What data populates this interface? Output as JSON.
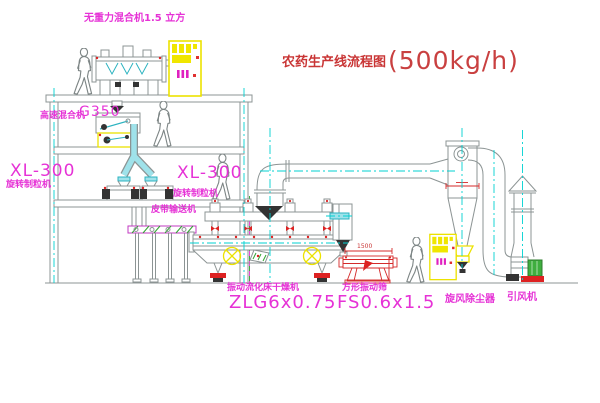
{
  "title": {
    "text": "农药生产线流程图",
    "capacity": "(500kg/h)"
  },
  "labels": {
    "gravity_mixer": "无重力混合机1.5 立方",
    "hs_mixer_name": "高速混合机",
    "hs_mixer_model": "G350",
    "xl300_left": "XL-300",
    "granulator_left": "旋转制粒机",
    "xl300_right": "XL-300",
    "granulator_right": "旋转制粒机",
    "belt_conveyor": "皮带输送机",
    "dryer_name": "振动流化床干燥机",
    "dryer_model": "ZLG6x0.75",
    "sieve_name": "方形振动筛",
    "sieve_model": "FS0.6x1.5",
    "cyclone": "旋风除尘器",
    "fan": "引风机"
  },
  "dimensions": {
    "sieve_width": "1500"
  },
  "colors": {
    "line": "#8c9494",
    "centerline_cyan": "#00d2d2",
    "label_magenta": "#e632d6",
    "title_red": "#c93535",
    "accent_yellow": "#ece200",
    "accent_red": "#dd2222",
    "accent_green": "#3fae3f"
  },
  "icons": {
    "person": "walking-person-figure",
    "cabinet": "electric-control-cabinet",
    "motor_circle": "vibration-motor-crossed-circle"
  }
}
